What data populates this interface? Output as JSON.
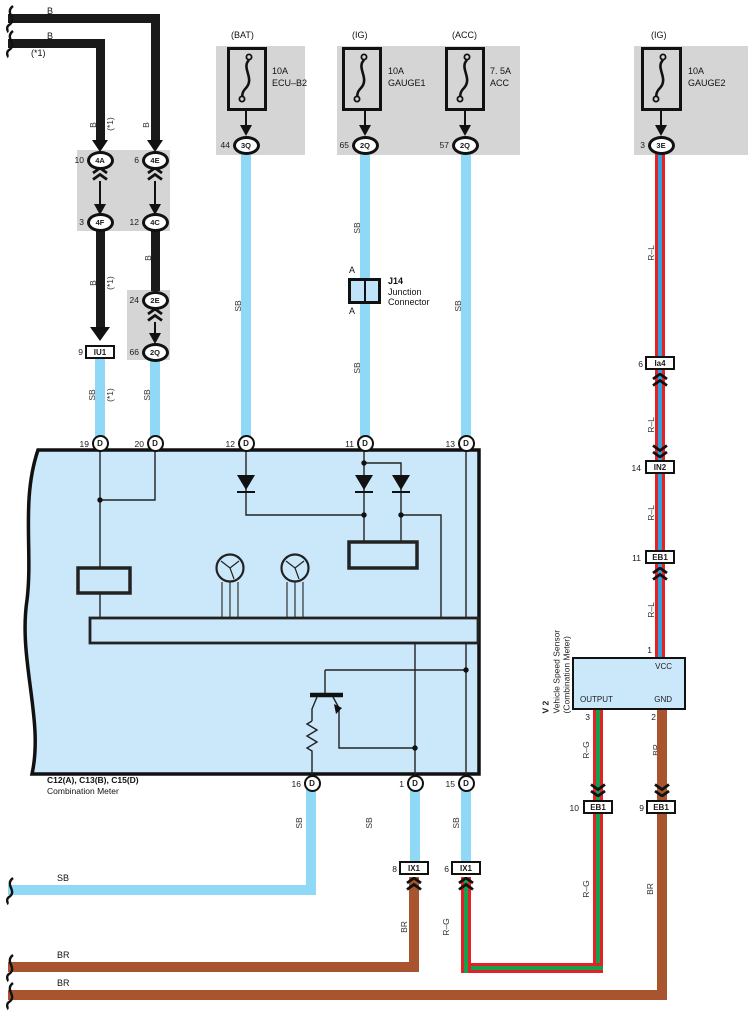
{
  "colors": {
    "black_wire": "#1a1a1a",
    "sb_wire": "#8FD8F6",
    "br_wire": "#A8552F",
    "red_wire": "#E32227",
    "blue_stripe": "#35A0D9",
    "green_stripe": "#14A14B",
    "meter_fill": "#CBE8FA",
    "gray_box": "#d5d5d5"
  },
  "top_left": {
    "b1": "B",
    "b2": "B",
    "note": "(*1)",
    "v_b1": "B",
    "v_note1": "(*1)",
    "v_b2": "B",
    "v_b3": "B",
    "v_note2": "(*1)",
    "v_b4": "B",
    "sb1": "SB",
    "sb1_note": "(*1)",
    "sb2": "SB",
    "c4a_num": "10",
    "c4a": "4A",
    "c4e_num": "6",
    "c4e": "4E",
    "c4f_num": "3",
    "c4f": "4F",
    "c4c_num": "12",
    "c4c": "4C",
    "c2e_num": "24",
    "c2e": "2E",
    "c2q_num": "66",
    "c2q": "2Q",
    "iu1_num": "9",
    "iu1": "IU1"
  },
  "fuses": {
    "bat": {
      "terminal": "(BAT)",
      "rating": "10A",
      "name": "ECU–B2",
      "pin": "44",
      "conn": "3Q",
      "wire": "SB"
    },
    "ig1": {
      "terminal": "(IG)",
      "rating": "10A",
      "name": "GAUGE1",
      "pin": "65",
      "conn": "2Q",
      "wire_upper": "SB",
      "wire_lower": "SB"
    },
    "acc": {
      "terminal": "(ACC)",
      "rating": "7. 5A",
      "name": "ACC",
      "pin": "57",
      "conn": "2Q",
      "wire": "SB"
    },
    "ig2": {
      "terminal": "(IG)",
      "rating": "10A",
      "name": "GAUGE2",
      "pin": "3",
      "conn": "3E"
    }
  },
  "j14": {
    "code": "J14",
    "line1": "Junction",
    "line2": "Connector",
    "a_top": "A",
    "a_bottom": "A"
  },
  "meter": {
    "code": "C12(A), C13(B), C15(D)",
    "name": "Combination Meter",
    "p19": "19",
    "p20": "20",
    "p12": "12",
    "p11": "11",
    "p13": "13",
    "p16": "16",
    "p1": "1",
    "p15": "15",
    "d": "D",
    "speedometer": "Speedometer",
    "tachometer": "Tachometer",
    "sb16": "SB",
    "sb1": "SB",
    "sb15": "SB"
  },
  "right": {
    "rl1": "R–L",
    "rl2": "R–L",
    "rl3": "R–L",
    "rl4": "R–L",
    "ia4_num": "6",
    "ia4": "Ia4",
    "in2_num": "14",
    "in2": "IN2",
    "eb1a_num": "11",
    "eb1a": "EB1"
  },
  "v2": {
    "id": "V 2",
    "name": "Vehicle Speed Sensor",
    "sub": "(Combination Meter)",
    "vcc": "VCC",
    "output": "OUTPUT",
    "gnd": "GND",
    "pin_vcc": "1",
    "pin_out": "3",
    "pin_gnd": "2"
  },
  "bottom": {
    "rg1": "R–G",
    "br1": "BR",
    "eb1b_num": "10",
    "eb1b": "EB1",
    "eb1c_num": "9",
    "eb1c": "EB1",
    "rg2": "R–G",
    "br2": "BR",
    "rg3": "R–G",
    "br3": "BR",
    "ix1a_num": "8",
    "ix1a": "IX1",
    "ix1b_num": "6",
    "ix1b": "IX1",
    "sb_h": "SB",
    "br_h1": "BR",
    "br_h2": "BR"
  }
}
